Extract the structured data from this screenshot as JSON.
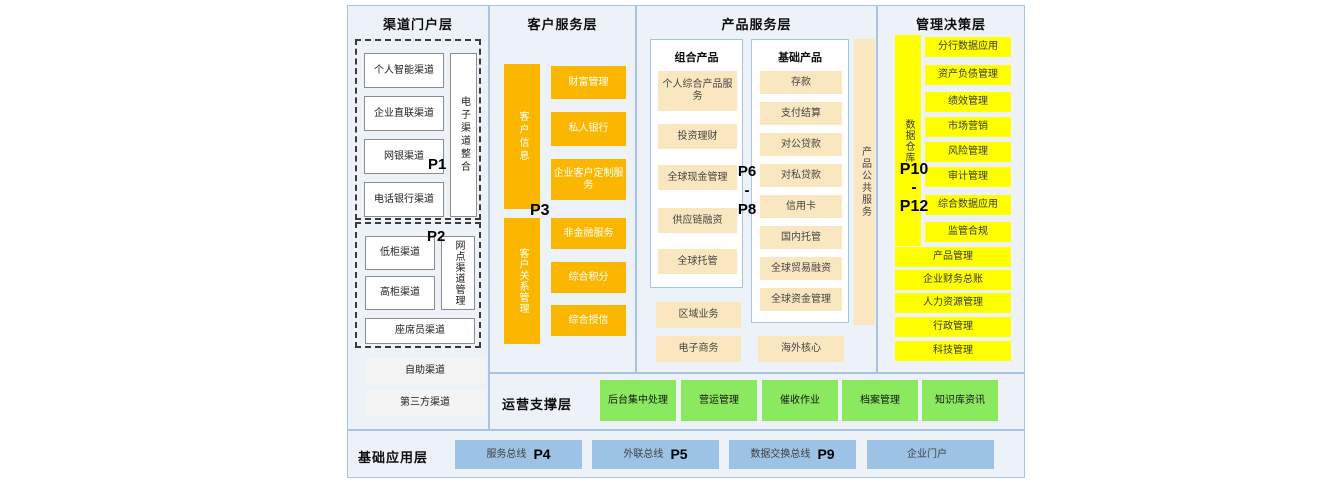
{
  "portal": {
    "title": "渠道门户层",
    "p1_label": "P1",
    "p1_items": [
      "个人智能渠道",
      "企业直联渠道",
      "网银渠道",
      "电话银行渠道"
    ],
    "p1_side": "电子渠道整合",
    "p2_label": "P2",
    "p2_items": [
      "低柜渠道",
      "高柜渠道"
    ],
    "p2_side": "网点渠道管理",
    "p2_bottom": "座席员渠道",
    "extra_items": [
      "自助渠道",
      "第三方渠道"
    ]
  },
  "customer": {
    "title": "客户服务层",
    "p3_label": "P3",
    "bar1": "客户信息",
    "bar1_items": [
      "财富管理",
      "私人银行",
      "企业客户定制服务"
    ],
    "bar2": "客户关系管理",
    "bar2_items": [
      "非金融服务",
      "综合积分",
      "综合授信"
    ]
  },
  "product": {
    "title": "产品服务层",
    "p_top": "P6",
    "p_dash": "-",
    "p_bottom": "P8",
    "combo_title": "组合产品",
    "combo_items": [
      "个人综合产品服务",
      "投资理财",
      "全球现金管理",
      "供应链融资",
      "全球托管"
    ],
    "basic_title": "基础产品",
    "basic_items": [
      "存款",
      "支付结算",
      "对公贷款",
      "对私贷款",
      "信用卡",
      "国内托管",
      "全球贸易融资",
      "全球资金管理"
    ],
    "side_bar": "产品公共服务",
    "bottom_items": [
      "区域业务",
      "电子商务"
    ],
    "overseas": "海外核心"
  },
  "management": {
    "title": "管理决策层",
    "p_top": "P10",
    "p_dash": "-",
    "p_bottom": "P12",
    "bar": "数据仓库",
    "items": [
      "分行数据应用",
      "资产负债管理",
      "绩效管理",
      "市场营销",
      "风险管理",
      "审计管理",
      "综合数据应用",
      "监管合规"
    ],
    "wide_items": [
      "产品管理",
      "企业财务总账",
      "人力资源管理",
      "行政管理",
      "科技管理"
    ]
  },
  "operation": {
    "title": "运营支撑层",
    "items": [
      "后台集中处理",
      "营运管理",
      "催收作业",
      "档案管理",
      "知识库资讯"
    ]
  },
  "foundation": {
    "title": "基础应用层",
    "items": [
      {
        "label": "服务总线",
        "p": "P4"
      },
      {
        "label": "外联总线",
        "p": "P5"
      },
      {
        "label": "数据交换总线",
        "p": "P9"
      },
      {
        "label": "企业门户",
        "p": ""
      }
    ]
  },
  "colors": {
    "orange": "#FBB700",
    "cream": "#FAE6BF",
    "yellow": "#FFFF00",
    "green": "#8BE95F",
    "blue": "#9CC2E5",
    "section_bg": "#EDF2F9",
    "section_border": "#A6C4E3"
  }
}
